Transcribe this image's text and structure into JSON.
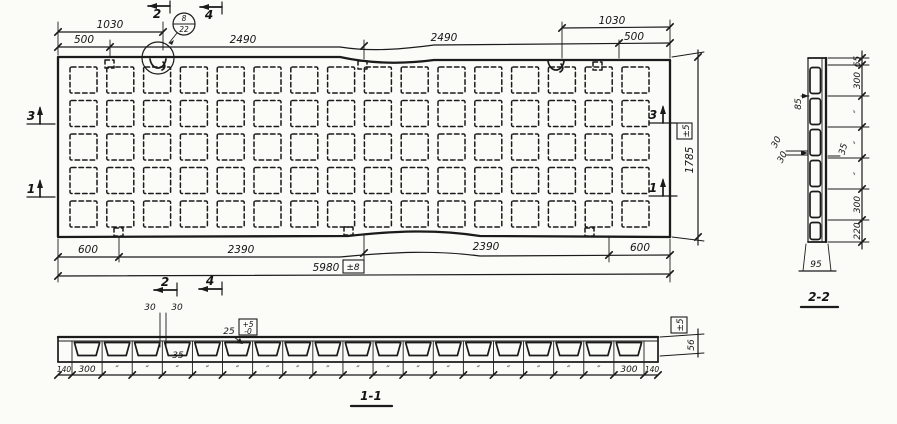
{
  "title": "precast ribbed panel working drawing",
  "plan": {
    "dim_1030_left": "1030",
    "dim_1030_right": "1030",
    "dim_500_left": "500",
    "dim_500_right": "500",
    "dim_2490_left": "2490",
    "dim_2490_right": "2490",
    "dim_600_left": "600",
    "dim_600_right": "600",
    "dim_2390_left": "2390",
    "dim_2390_right": "2390",
    "dim_total": "5980",
    "dim_total_tol": "±8",
    "dim_width": "1785",
    "dim_width_tol": "±5",
    "mark_2": "2",
    "mark_4": "4",
    "mark_3": "3",
    "mark_1": "1",
    "callout_top": "8",
    "callout_bottom": "22",
    "grid_rows": 5,
    "grid_cols": 16
  },
  "section11": {
    "label": "1-1",
    "d30_left": "30",
    "d30_right": "30",
    "d35": "35",
    "d25": "25",
    "tol_plus": "+5",
    "tol_minus": "-0",
    "dim_h": "56",
    "tol_h": "±5",
    "edge_left": "140",
    "cell_first": "300",
    "cell_last": "300",
    "edge_right": "140",
    "ditto": "″",
    "cells": 19
  },
  "section22": {
    "label": "2-2",
    "dims_right": [
      "65",
      "300",
      "″",
      "″",
      "″",
      "300",
      "220"
    ],
    "dim_bottom": "95",
    "d85": "85",
    "d30_upper": "30",
    "d30_lower": "30",
    "d35": "35",
    "cells": 6
  }
}
